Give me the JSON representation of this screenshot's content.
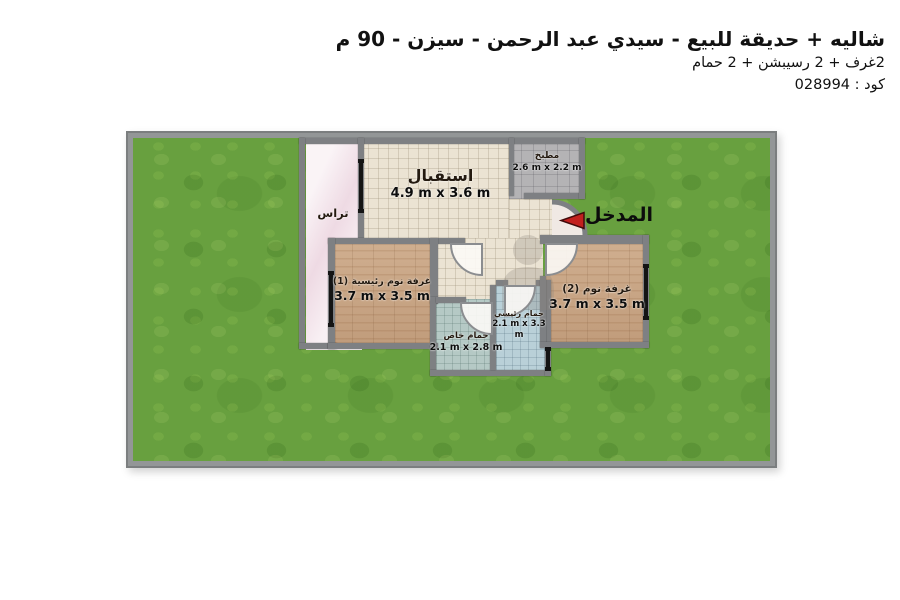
{
  "header": {
    "title": "شاليه + حديقة للبيع - سيدي عبد الرحمن - سيزن - 90 م",
    "subtitle": "2غرف + 2 رسيبشن + 2 حمام",
    "code": "كود : 028994"
  },
  "plan": {
    "entrance": {
      "label": "المدخل"
    },
    "rooms": {
      "terrace": {
        "name": "تراس"
      },
      "reception": {
        "name": "استقبال",
        "dims": "4.9 m x 3.6 m"
      },
      "kitchen": {
        "name": "مطبخ",
        "dims": "2.6 m x 2.2 m"
      },
      "master_bedroom": {
        "name": "غرفة نوم رئيسية (1)",
        "dims": "3.7 m x 3.5 m"
      },
      "bedroom_2": {
        "name": "غرفة نوم (2)",
        "dims": "3.7 m x 3.5 m"
      },
      "private_bath": {
        "name": "حمام خاص",
        "dims": "2.1 m x 2.8 m"
      },
      "main_bath": {
        "name": "حمام رئيسي",
        "dims": "2.1 m x 3.3 m"
      }
    },
    "colors": {
      "grass": "#68a03f",
      "terrace": "#f4e6ec",
      "floor_tile": "#ebe3d3",
      "kitchen": "#b4b3b5",
      "wood": "#c9a686",
      "bath_private": "#b5c9c5",
      "bath_main": "#b9d0d8",
      "wall": "#7e8083",
      "entrance_arrow": "#c2201e"
    }
  }
}
